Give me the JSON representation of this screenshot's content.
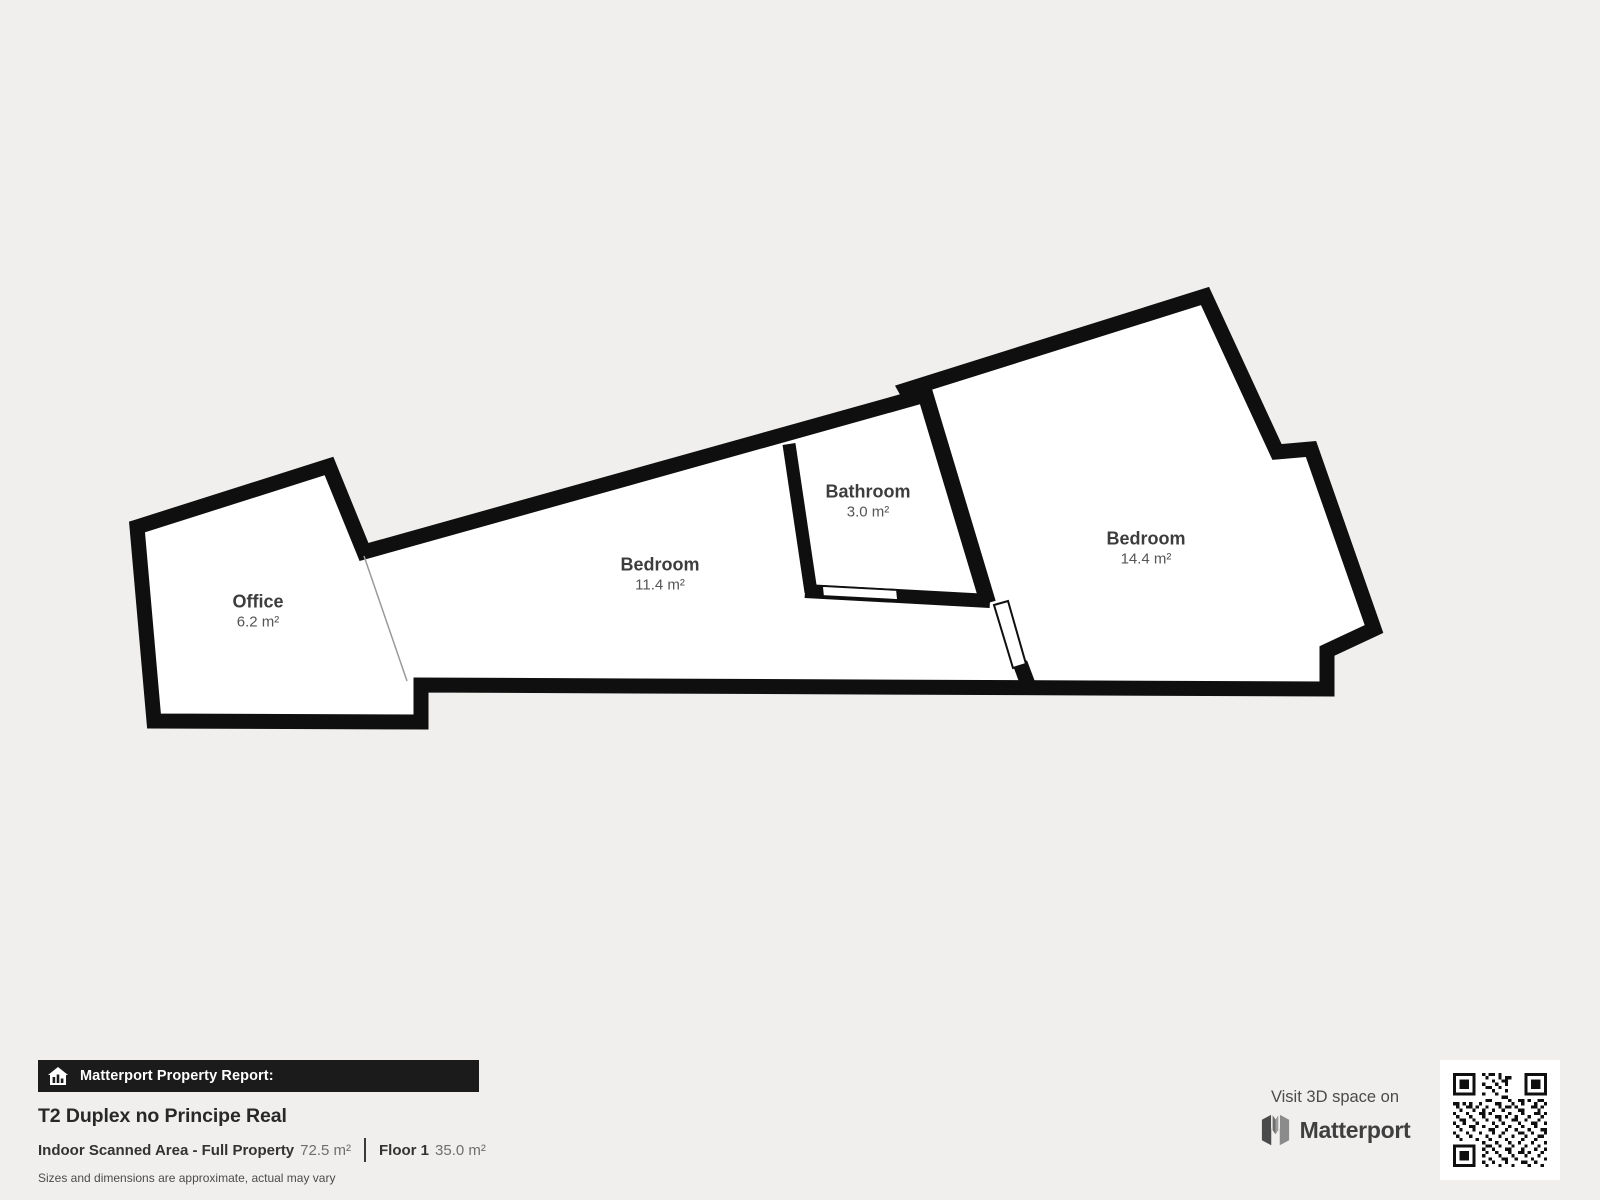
{
  "floorplan": {
    "rooms": [
      {
        "name": "Office",
        "area": "6.2 m²"
      },
      {
        "name": "Bedroom",
        "area": "11.4 m²"
      },
      {
        "name": "Bathroom",
        "area": "3.0 m²"
      },
      {
        "name": "Bedroom",
        "area": "14.4 m²"
      }
    ]
  },
  "report": {
    "banner_title": "Matterport Property Report:",
    "title": "T2 Duplex no Principe Real",
    "scanned_area_label": "Indoor Scanned Area - Full Property",
    "scanned_area_value": "72.5 m²",
    "floor_label": "Floor 1",
    "floor_value": "35.0 m²",
    "disclaimer": "Sizes and dimensions are approximate, actual may vary"
  },
  "promo": {
    "visit_text": "Visit 3D space on",
    "brand_name": "Matterport"
  },
  "colors": {
    "background": "#f0efed",
    "wall": "#0f0f0f",
    "floor": "#ffffff",
    "room_name_text": "#3d3d3d",
    "room_area_text": "#555555",
    "banner_background": "#1b1b1b",
    "banner_text": "#ffffff"
  }
}
